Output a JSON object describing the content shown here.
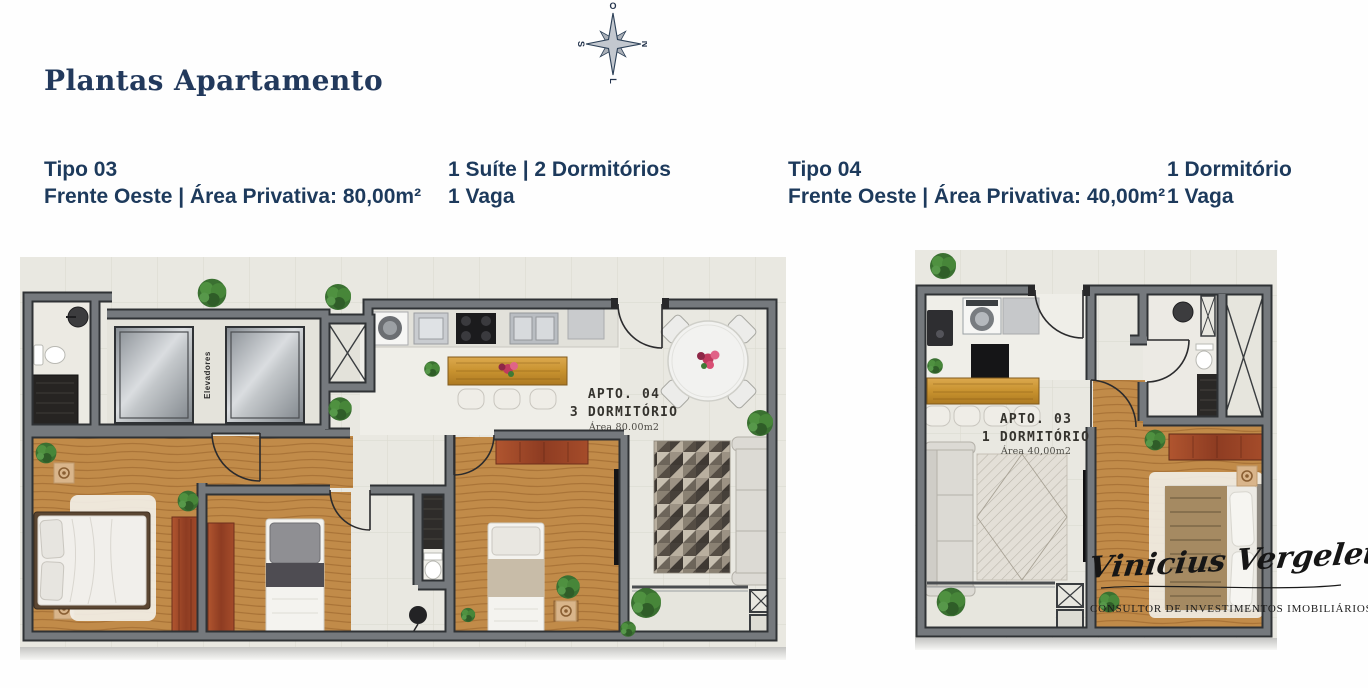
{
  "page": {
    "title": "Plantas Apartamento"
  },
  "compass": {
    "top": "O",
    "right": "N",
    "bottom": "L",
    "left": "S"
  },
  "units": [
    {
      "type_label": "Tipo 03",
      "front_area_label": "Frente Oeste | Área Privativa: 80,00m²",
      "features_line1": "1 Suíte | 2 Dormitórios",
      "features_line2": "1 Vaga",
      "plan": {
        "apto": "Apto. 04",
        "dorm": "3 Dormitório",
        "area": "Área 80.00m2",
        "elevators": "Elevadores"
      }
    },
    {
      "type_label": "Tipo 04",
      "front_area_label": "Frente Oeste | Área Privativa: 40,00m²",
      "features_line1": "1 Dormitório",
      "features_line2": "1 Vaga",
      "plan": {
        "apto": "Apto. 03",
        "dorm": "1 Dormitório",
        "area": "Área 40,00m2"
      }
    }
  ],
  "signature": {
    "name": "Vinicius Vergeletti",
    "role": "CONSULTOR DE INVESTIMENTOS IMOBILIÁRIOS"
  },
  "colors": {
    "accent_navy": "#1d3a5c",
    "wall_gray": "#75797d",
    "wood_floor": "#c18b49",
    "bar_wood": "#c8922f",
    "wardrobe_red": "#8e3c22",
    "label_dark": "#35332e"
  }
}
